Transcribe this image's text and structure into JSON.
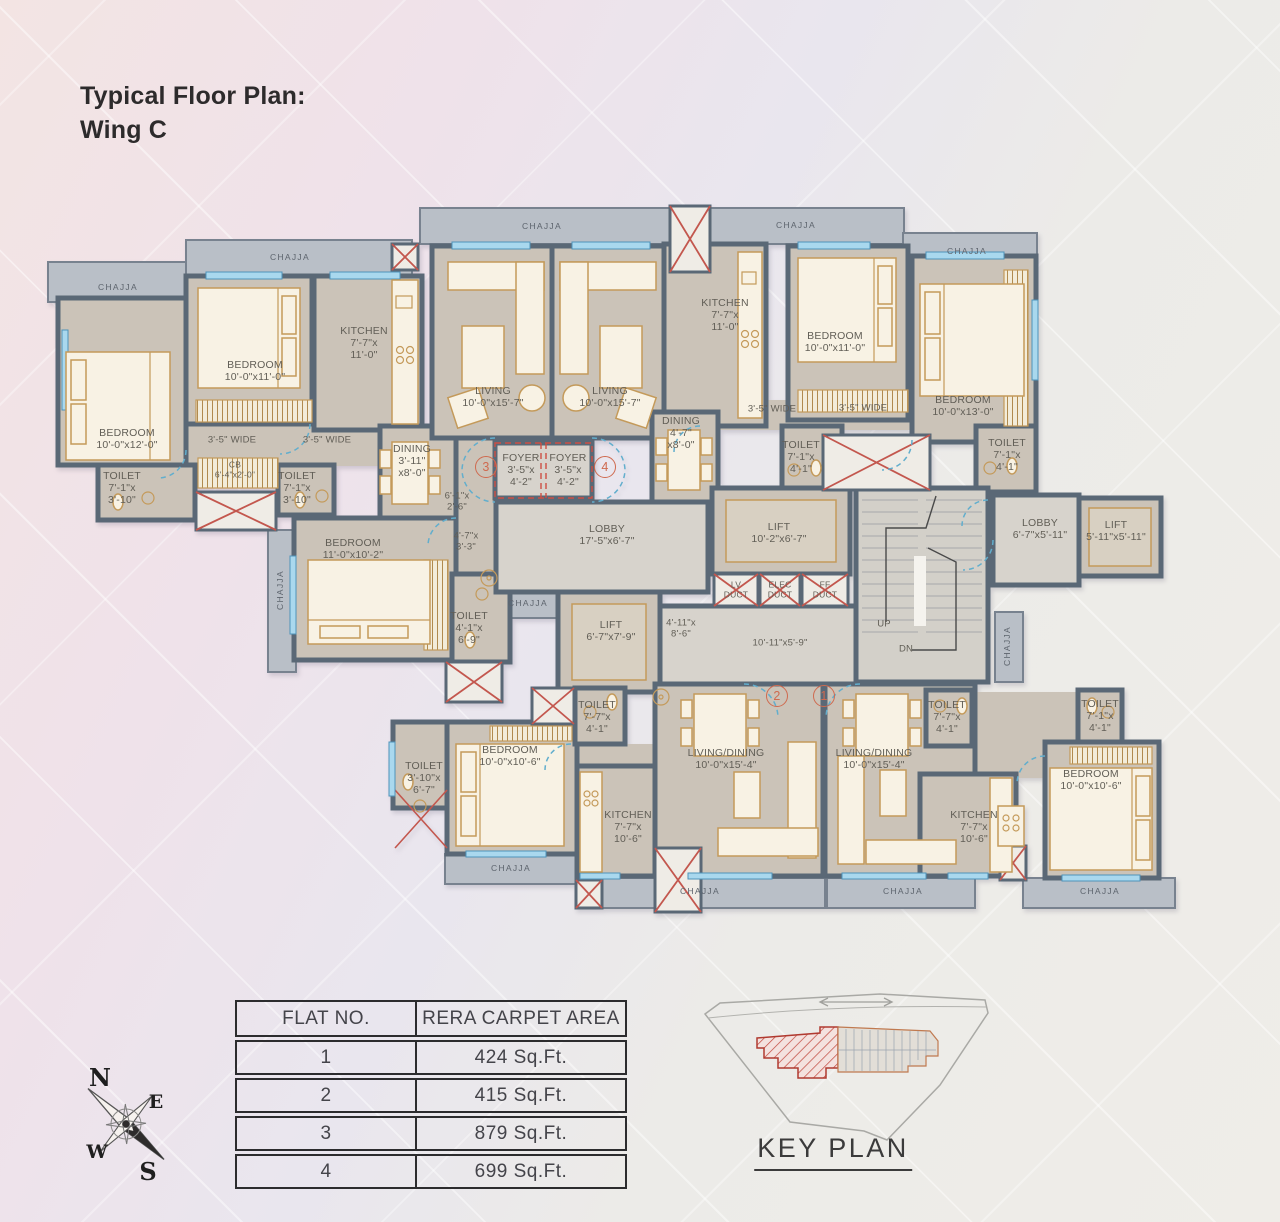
{
  "title": {
    "line1": "Typical Floor Plan:",
    "line2": "Wing C"
  },
  "colors": {
    "wall": "#5a6876",
    "room_fill": "#cbc3b8",
    "lobby_fill": "#d7d3cc",
    "chajja_fill": "#b9bfc7",
    "window": "#a9d8ee",
    "furniture_fill": "#f8f2e4",
    "furniture_stroke": "#c49a5a",
    "shaft_x": "#c3574e",
    "door_arc": "#62aecd",
    "foyer_dash": "#cd4f43",
    "label_text": "#615e56",
    "circle_accent": "#cf6a4f"
  },
  "plan": {
    "labels": [
      {
        "n": "chajja-label",
        "t": "CHAJJA",
        "x": 118,
        "y": 288,
        "sp": 1,
        "fs": 8.5
      },
      {
        "n": "chajja-label",
        "t": "CHAJJA",
        "x": 290,
        "y": 258,
        "sp": 1,
        "fs": 8.5
      },
      {
        "n": "chajja-label",
        "t": "CHAJJA",
        "x": 542,
        "y": 227,
        "sp": 1,
        "fs": 8.5
      },
      {
        "n": "chajja-label",
        "t": "CHAJJA",
        "x": 796,
        "y": 226,
        "sp": 1,
        "fs": 8.5
      },
      {
        "n": "chajja-label",
        "t": "CHAJJA",
        "x": 967,
        "y": 252,
        "sp": 1,
        "fs": 8.5
      },
      {
        "n": "chajja-label",
        "t": "CHAJJA",
        "x": 281,
        "y": 590,
        "sp": 1,
        "fs": 8.5,
        "r": -90
      },
      {
        "n": "chajja-label",
        "t": "CHAJJA",
        "x": 528,
        "y": 604,
        "sp": 1,
        "fs": 8.5
      },
      {
        "n": "chajja-label",
        "t": "CHAJJA",
        "x": 511,
        "y": 869,
        "sp": 1,
        "fs": 8.5
      },
      {
        "n": "chajja-label",
        "t": "CHAJJA",
        "x": 700,
        "y": 892,
        "sp": 1,
        "fs": 8.5
      },
      {
        "n": "chajja-label",
        "t": "CHAJJA",
        "x": 903,
        "y": 892,
        "sp": 1,
        "fs": 8.5
      },
      {
        "n": "chajja-label",
        "t": "CHAJJA",
        "x": 1100,
        "y": 892,
        "sp": 1,
        "fs": 8.5
      },
      {
        "n": "chajja-label",
        "t": "CHAJJA",
        "x": 1008,
        "y": 646,
        "sp": 1,
        "fs": 8.5,
        "r": -90
      },
      {
        "n": "label-bedroom",
        "t": "BEDROOM\n10'-0\"x12'-0\"",
        "x": 127,
        "y": 440
      },
      {
        "n": "label-bedroom",
        "t": "BEDROOM\n10'-0\"x11'-0\"",
        "x": 255,
        "y": 372
      },
      {
        "n": "label-kitchen",
        "t": "KITCHEN\n7'-7\"x\n11'-0\"",
        "x": 364,
        "y": 344
      },
      {
        "n": "label-living",
        "t": "LIVING\n10'-0\"x15'-7\"",
        "x": 493,
        "y": 398
      },
      {
        "n": "label-living",
        "t": "LIVING\n10'-0\"x15'-7\"",
        "x": 610,
        "y": 398
      },
      {
        "n": "label-kitchen",
        "t": "KITCHEN\n7'-7\"x\n11'-0\"",
        "x": 725,
        "y": 316
      },
      {
        "n": "label-bedroom",
        "t": "BEDROOM\n10'-0\"x11'-0\"",
        "x": 835,
        "y": 343
      },
      {
        "n": "label-bedroom",
        "t": "BEDROOM\n10'-0\"x13'-0\"",
        "x": 963,
        "y": 407
      },
      {
        "n": "label-dining",
        "t": "DINING\n3'-11\"\nx8'-0\"",
        "x": 412,
        "y": 462
      },
      {
        "n": "label-dining",
        "t": "DINING\n4'-7\"\nx8'-0\"",
        "x": 681,
        "y": 434
      },
      {
        "n": "label-toilet",
        "t": "TOILET\n7'-1\"x\n3'-10\"",
        "x": 122,
        "y": 489
      },
      {
        "n": "label-toilet",
        "t": "TOILET\n7'-1\"x\n3'-10\"",
        "x": 297,
        "y": 489
      },
      {
        "n": "label-cb",
        "t": "CB\n6'-4\"x2'-0\"",
        "x": 235,
        "y": 470,
        "fs": 8.5
      },
      {
        "n": "label-passage",
        "t": "3'-5\" WIDE",
        "x": 232,
        "y": 441,
        "fs": 9.5
      },
      {
        "n": "label-passage",
        "t": "3'-5\" WIDE",
        "x": 327,
        "y": 441,
        "fs": 9.5
      },
      {
        "n": "label-passage",
        "t": "3'-5\" WIDE",
        "x": 772,
        "y": 410,
        "fs": 9.5
      },
      {
        "n": "label-passage",
        "t": "3'-5\" WIDE",
        "x": 863,
        "y": 409,
        "fs": 9.5
      },
      {
        "n": "label-toilet",
        "t": "TOILET\n7'-1\"x\n4'-1\"",
        "x": 801,
        "y": 458
      },
      {
        "n": "label-toilet",
        "t": "TOILET\n7'-1\"x\n4'-1\"",
        "x": 1007,
        "y": 456
      },
      {
        "n": "label-foyer",
        "t": "FOYER\n3'-5\"x\n4'-2\"",
        "x": 521,
        "y": 471
      },
      {
        "n": "label-foyer",
        "t": "FOYER\n3'-5\"x\n4'-2\"",
        "x": 568,
        "y": 471
      },
      {
        "n": "label-dim",
        "t": "6'-1\"x\n2'-6\"",
        "x": 457,
        "y": 502,
        "fs": 9.5
      },
      {
        "n": "label-dim",
        "t": "4'-7\"x\n3'-3\"",
        "x": 466,
        "y": 542,
        "fs": 9.5
      },
      {
        "n": "label-bedroom",
        "t": "BEDROOM\n11'-0\"x10'-2\"",
        "x": 353,
        "y": 550
      },
      {
        "n": "label-toilet",
        "t": "TOILET\n4'-1\"x\n6'-9\"",
        "x": 469,
        "y": 629
      },
      {
        "n": "label-lobby",
        "t": "LOBBY\n17'-5\"x6'-7\"",
        "x": 607,
        "y": 536
      },
      {
        "n": "label-lift",
        "t": "LIFT\n10'-2\"x6'-7\"",
        "x": 779,
        "y": 534
      },
      {
        "n": "label-duct",
        "t": "LV\nDUCT",
        "x": 736,
        "y": 590,
        "fs": 8.5
      },
      {
        "n": "label-duct",
        "t": "ELEC\nDUCT",
        "x": 780,
        "y": 590,
        "fs": 8.5
      },
      {
        "n": "label-duct",
        "t": "FF\nDUCT",
        "x": 825,
        "y": 590,
        "fs": 8.5
      },
      {
        "n": "label-lift",
        "t": "LIFT\n6'-7\"x7'-9\"",
        "x": 611,
        "y": 632
      },
      {
        "n": "label-dim",
        "t": "4'-11\"x\n8'-6\"",
        "x": 681,
        "y": 629,
        "fs": 9.5
      },
      {
        "n": "label-dim",
        "t": "10'-11\"x5'-9\"",
        "x": 780,
        "y": 644,
        "fs": 9.5
      },
      {
        "n": "label-up",
        "t": "UP",
        "x": 884,
        "y": 625,
        "fs": 9.5
      },
      {
        "n": "label-dn",
        "t": "DN",
        "x": 906,
        "y": 650,
        "fs": 9.5
      },
      {
        "n": "label-lobby",
        "t": "LOBBY\n6'-7\"x5'-11\"",
        "x": 1040,
        "y": 530
      },
      {
        "n": "label-lift",
        "t": "LIFT\n5'-11\"x5'-11\"",
        "x": 1116,
        "y": 532
      },
      {
        "n": "label-toilet",
        "t": "TOILET\n3'-10\"x\n6'-7\"",
        "x": 424,
        "y": 779
      },
      {
        "n": "label-bedroom",
        "t": "BEDROOM\n10'-0\"x10'-6\"",
        "x": 510,
        "y": 757
      },
      {
        "n": "label-toilet",
        "t": "TOILET\n7'-7\"x\n4'-1\"",
        "x": 597,
        "y": 718
      },
      {
        "n": "label-kitchen",
        "t": "KITCHEN\n7'-7\"x\n10'-6\"",
        "x": 628,
        "y": 828
      },
      {
        "n": "label-living-dining",
        "t": "LIVING/DINING\n10'-0\"x15'-4\"",
        "x": 726,
        "y": 760
      },
      {
        "n": "label-living-dining",
        "t": "LIVING/DINING\n10'-0\"x15'-4\"",
        "x": 874,
        "y": 760
      },
      {
        "n": "label-toilet",
        "t": "TOILET\n7'-7\"x\n4'-1\"",
        "x": 947,
        "y": 718
      },
      {
        "n": "label-toilet",
        "t": "TOILET\n7'-1\"x\n4'-1\"",
        "x": 1100,
        "y": 717
      },
      {
        "n": "label-kitchen",
        "t": "KITCHEN\n7'-7\"x\n10'-6\"",
        "x": 974,
        "y": 828
      },
      {
        "n": "label-bedroom",
        "t": "BEDROOM\n10'-0\"x10'-6\"",
        "x": 1091,
        "y": 781
      },
      {
        "n": "flat-number-3",
        "t": "3",
        "x": 486,
        "y": 467,
        "c": 1
      },
      {
        "n": "flat-number-4",
        "t": "4",
        "x": 605,
        "y": 467,
        "c": 1
      },
      {
        "n": "flat-number-2",
        "t": "2",
        "x": 777,
        "y": 696,
        "c": 1
      },
      {
        "n": "flat-number-1",
        "t": "1",
        "x": 824,
        "y": 696,
        "c": 1
      }
    ]
  },
  "table": {
    "headers": [
      "FLAT NO.",
      "RERA CARPET AREA"
    ],
    "rows": [
      {
        "no": "1",
        "area": "424 Sq.Ft."
      },
      {
        "no": "2",
        "area": "415 Sq.Ft."
      },
      {
        "no": "3",
        "area": "879 Sq.Ft."
      },
      {
        "no": "4",
        "area": "699 Sq.Ft."
      }
    ]
  },
  "key_plan": {
    "caption": "KEY PLAN"
  },
  "compass": {
    "n": "N",
    "e": "E",
    "w": "W",
    "s": "S"
  }
}
